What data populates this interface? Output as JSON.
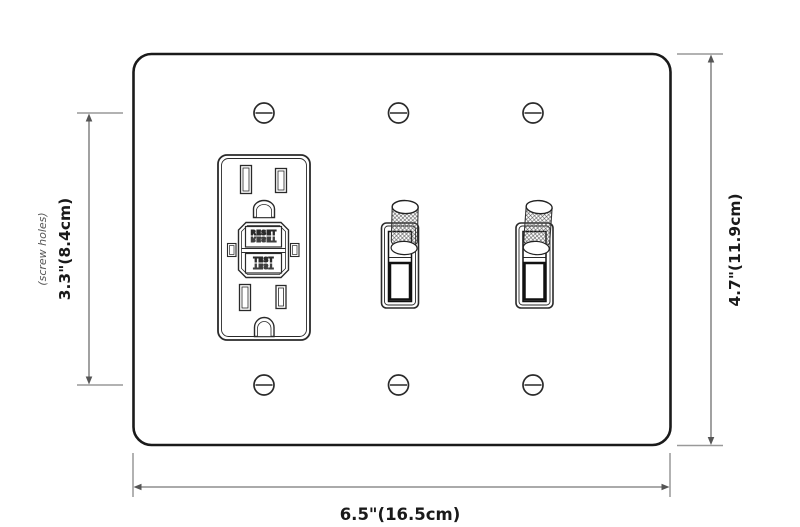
{
  "diagram": {
    "type": "wall-plate-dimension-diagram",
    "labels": {
      "width": "6.5\"(16.5cm)",
      "height": "4.7\"(11.9cm)",
      "screw_spacing": "3.3\"(8.4cm)",
      "screw_note": "(screw holes)"
    },
    "gfci": {
      "reset": "RESET",
      "test": "TEST"
    },
    "colors": {
      "background": "#ffffff",
      "plate_line": "#1a1a1a",
      "device_line": "#2a2a2a",
      "dim_line": "#666666",
      "tick_line": "#999999",
      "label_text": "#1a1a1a",
      "note_text": "#555555"
    }
  }
}
